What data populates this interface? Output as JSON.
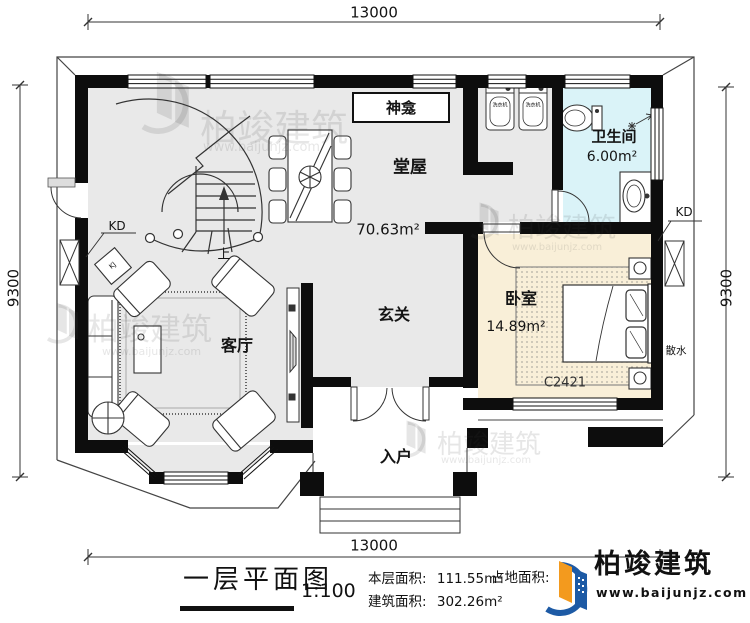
{
  "dimensions": {
    "top": "13000",
    "bottom": "13000",
    "left": "9300",
    "right": "9300"
  },
  "rooms": {
    "shenkan": {
      "name": "神龛"
    },
    "tangwu": {
      "name": "堂屋",
      "area": "70.63m²"
    },
    "weishengjian": {
      "name": "卫生间",
      "area": "6.00m²"
    },
    "woshi": {
      "name": "卧室",
      "area": "14.89m²"
    },
    "xuanguan": {
      "name": "玄关"
    },
    "keting": {
      "name": "客厅"
    },
    "ruhu": {
      "name": "入户"
    }
  },
  "annotations": {
    "kd_left": "KD",
    "kd_right": "KD",
    "sanshui": "散水",
    "window_code": "C2421",
    "stairs_up": "上",
    "ac_indoor": "KJ",
    "washer": "洗衣机"
  },
  "title_block": {
    "title": "一层平面图",
    "scale": "1:100",
    "floor_area_label": "本层面积:",
    "floor_area_value": "111.55m²",
    "build_area_label": "建筑面积:",
    "build_area_value": "302.26m²",
    "land_area_label": "占地面积:",
    "brand": "柏竣建筑",
    "website": "www.baijunjz.com"
  },
  "watermark": {
    "brand": "柏竣建筑",
    "website": "www.baijunjz.com"
  },
  "colors": {
    "floor": "#e9e9e9",
    "bathroom": "#daf3f8",
    "bedroom": "#f9efd8",
    "wall": "#0d0d0d",
    "logo_blue": "#1d5aa5",
    "logo_orange": "#f39a1e"
  }
}
